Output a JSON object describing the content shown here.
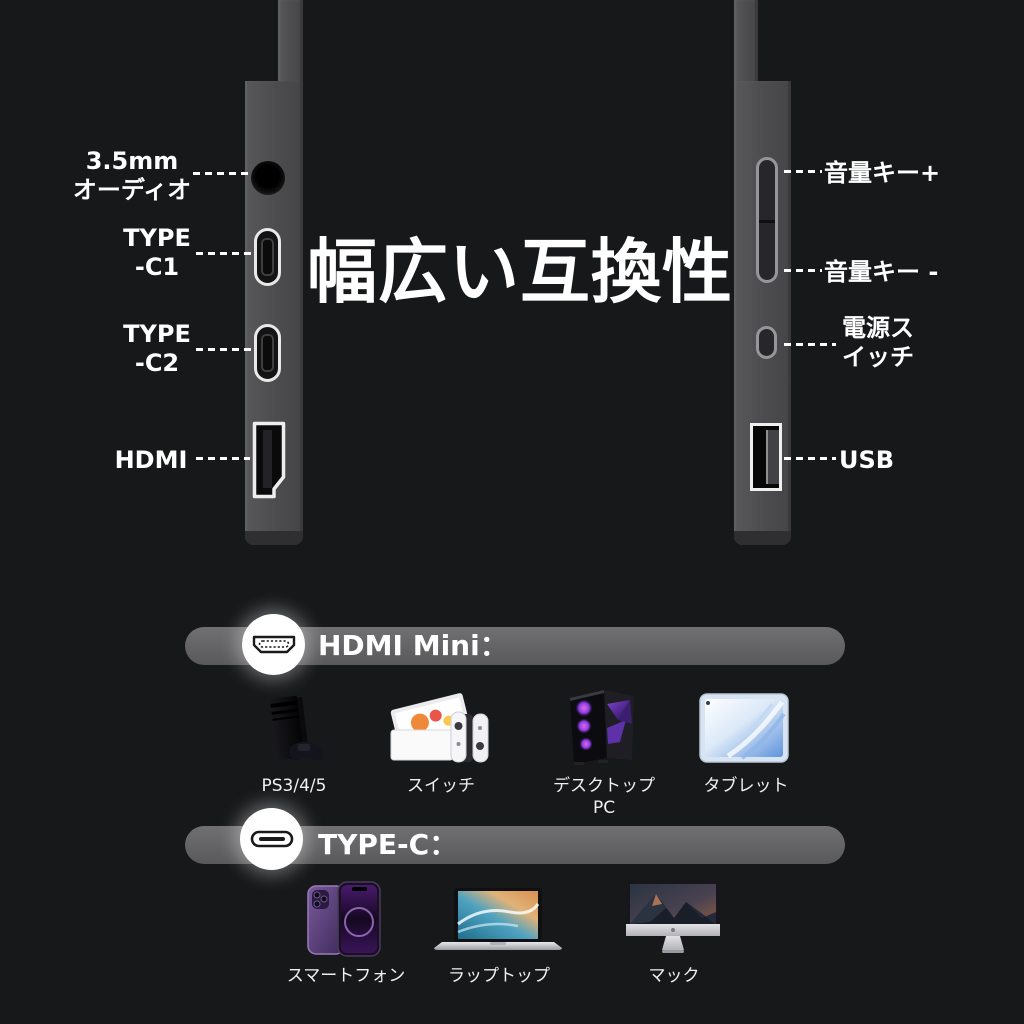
{
  "title": "幅広い互換性",
  "colors": {
    "background": "#17181a",
    "edge_gray": "#4c4c4e",
    "bar_gray": "#646464",
    "text_white": "#ffffff"
  },
  "left_panel": {
    "ports": [
      {
        "name": "audio-jack",
        "label": "3.5mm\nオーディオ"
      },
      {
        "name": "type-c1",
        "label": "TYPE\n-C1"
      },
      {
        "name": "type-c2",
        "label": "TYPE\n-C2"
      },
      {
        "name": "hdmi",
        "label": "HDMI"
      }
    ]
  },
  "right_panel": {
    "controls": [
      {
        "name": "volume-up",
        "label": "音量キー+"
      },
      {
        "name": "volume-down",
        "label": "音量キー -"
      },
      {
        "name": "power-switch",
        "label": "電源ス\nイッチ"
      },
      {
        "name": "usb",
        "label": "USB"
      }
    ]
  },
  "sections": [
    {
      "heading": "HDMI Mini：",
      "icon": "hdmi-connector-icon",
      "devices": [
        {
          "label": "PS3/4/5",
          "image": "playstation-console"
        },
        {
          "label": "スイッチ",
          "image": "nintendo-switch"
        },
        {
          "label": "デスクトップPC",
          "image": "desktop-pc-tower"
        },
        {
          "label": "タブレット",
          "image": "tablet"
        }
      ]
    },
    {
      "heading": "TYPE-C：",
      "icon": "type-c-connector-icon",
      "devices": [
        {
          "label": "スマートフォン",
          "image": "smartphone"
        },
        {
          "label": "ラップトップ",
          "image": "laptop"
        },
        {
          "label": "マック",
          "image": "imac"
        }
      ]
    }
  ]
}
